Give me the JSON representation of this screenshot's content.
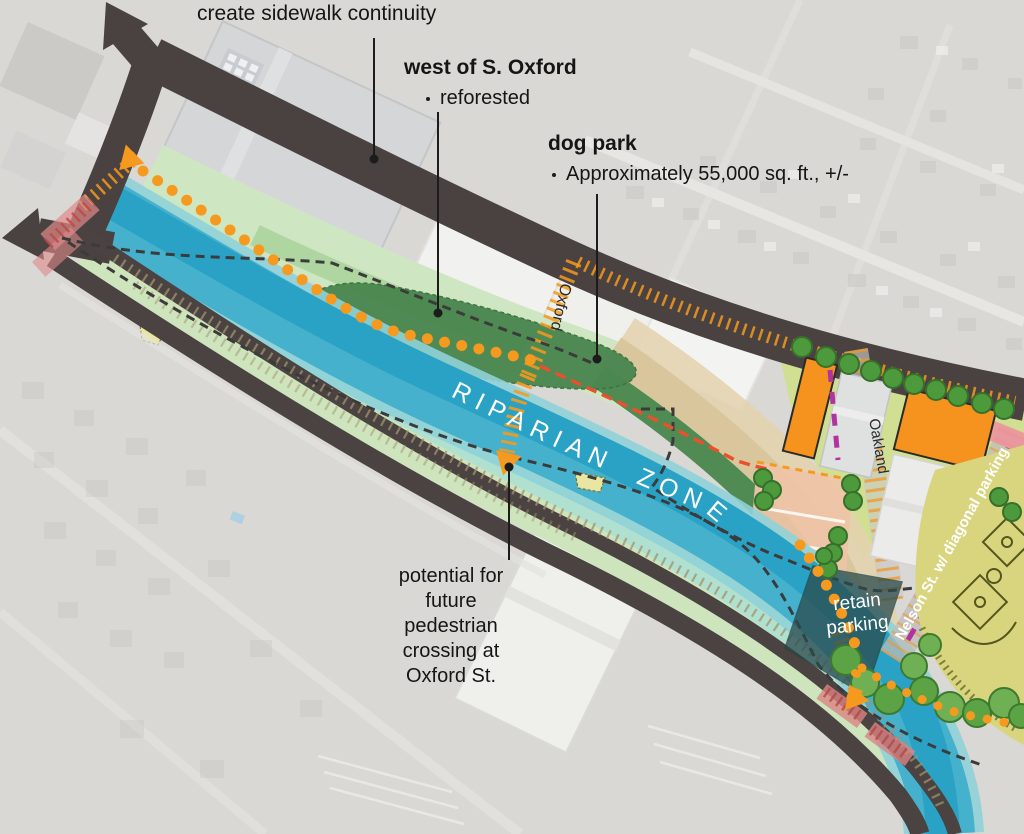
{
  "annotations": {
    "sidewalk_note": "create sidewalk continuity",
    "west_oxford": {
      "title": "west of S. Oxford",
      "bullet": "reforested"
    },
    "dog_park": {
      "title": "dog park",
      "bullet": "Approximately 55,000 sq. ft., +/-"
    },
    "crossing_note": {
      "line1": "potential for",
      "line2": "future",
      "line3": "pedestrian",
      "line4": "crossing at",
      "line5": "Oxford St."
    }
  },
  "map_labels": {
    "riparian_zone": "RIPARIAN ZONE",
    "oxford_street": "Oxford",
    "oakland_street": "Oakland",
    "nelson_street": "Nelson St. w/ diagonal parking",
    "retain_parking": {
      "line1": "retain",
      "line2": "parking"
    }
  },
  "colors": {
    "road": "#4a4240",
    "stream": "#2aa2c5",
    "stream_light": "#7fd0d8",
    "vegetation_light": "#cfe5c1",
    "vegetation_dark": "#4b8750",
    "tan_path": "#d9c69c",
    "path_orange": "#f59a1e",
    "boundary_red": "#e8512c",
    "parking_magenta": "#b133a0",
    "building_orange": "#f6921e",
    "field_yellow": "#d9d57e",
    "crossing_pink": "#e08a8a"
  }
}
